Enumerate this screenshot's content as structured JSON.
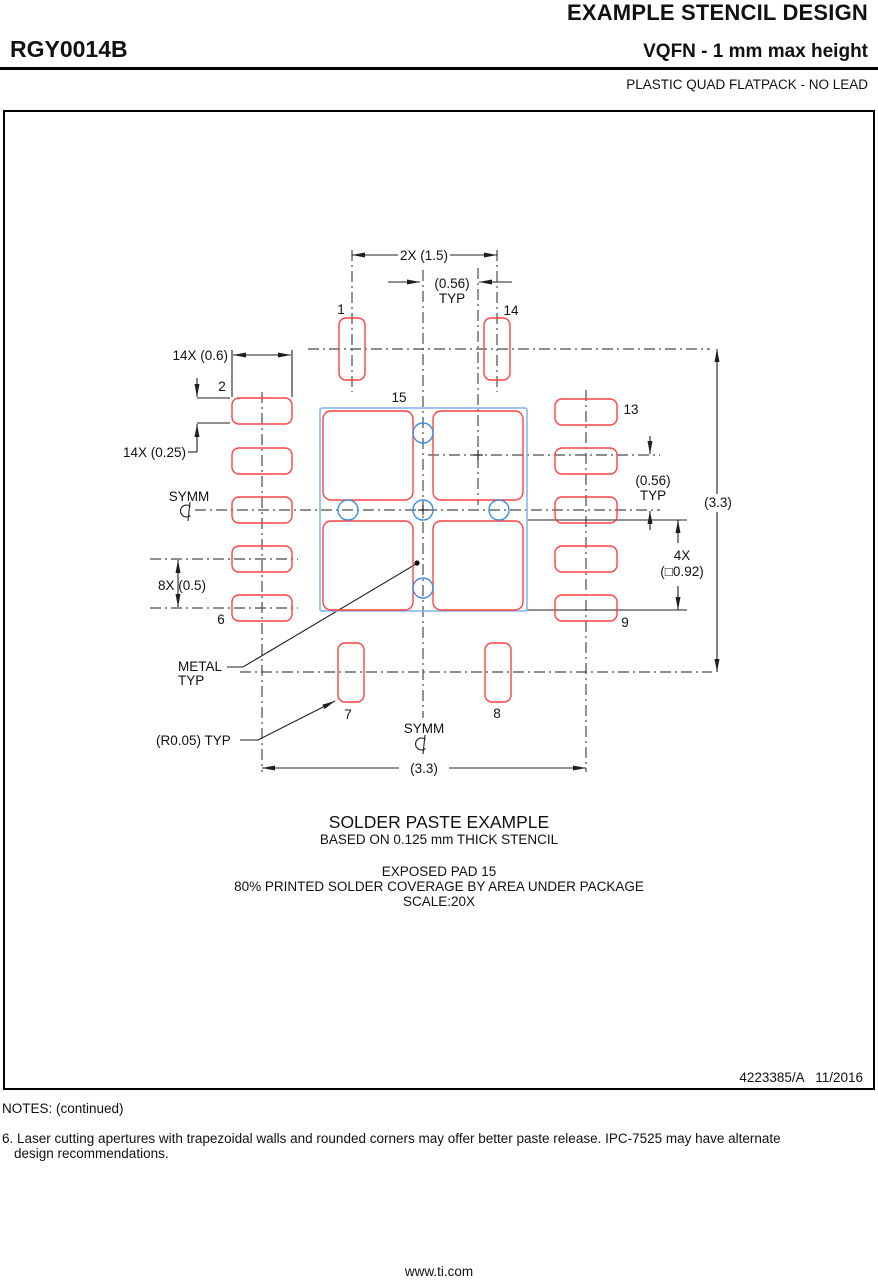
{
  "header": {
    "doc_title": "EXAMPLE STENCIL DESIGN",
    "part_number": "RGY0014B",
    "package_type": "VQFN - 1 mm max height",
    "package_desc": "PLASTIC QUAD FLATPACK - NO LEAD"
  },
  "drawing": {
    "dims": {
      "pitch_top": "2X (1.5)",
      "clearance": "(0.56)",
      "typ": "TYP",
      "pad_length": "14X (0.6)",
      "pad_width": "14X (0.25)",
      "side_pitch": "8X (0.5)",
      "body_width": "(3.3)",
      "body_height": "(3.3)",
      "via_count": "4X",
      "via_size": "(□0.92)",
      "radius": "(R0.05) TYP"
    },
    "labels": {
      "symm": "SYMM",
      "metal_l1": "METAL",
      "metal_l2": "TYP"
    },
    "pins": {
      "p1": "1",
      "p2": "2",
      "p6": "6",
      "p7": "7",
      "p8": "8",
      "p9": "9",
      "p13": "13",
      "p14": "14",
      "p15": "15"
    }
  },
  "caption": {
    "line1": "SOLDER PASTE EXAMPLE",
    "line2": "BASED ON 0.125 mm THICK STENCIL",
    "line3": "EXPOSED PAD 15",
    "line4": "80% PRINTED SOLDER COVERAGE BY AREA UNDER PACKAGE",
    "line5": "SCALE:20X"
  },
  "doc_number": "4223385/A   11/2016",
  "notes": {
    "heading": "NOTES: (continued)",
    "note6_line1": "6. Laser cutting apertures with trapezoidal walls and rounded corners may offer better paste release. IPC-7525 may have alternate",
    "note6_line2": "design recommendations."
  },
  "footer": {
    "url": "www.ti.com"
  },
  "colors": {
    "pad_red": "#ff4242",
    "epad_blue": "#7fb3e8",
    "via_blue": "#3e8ede",
    "centerline": "#4a4a4a",
    "dimension": "#1f1f1f"
  }
}
